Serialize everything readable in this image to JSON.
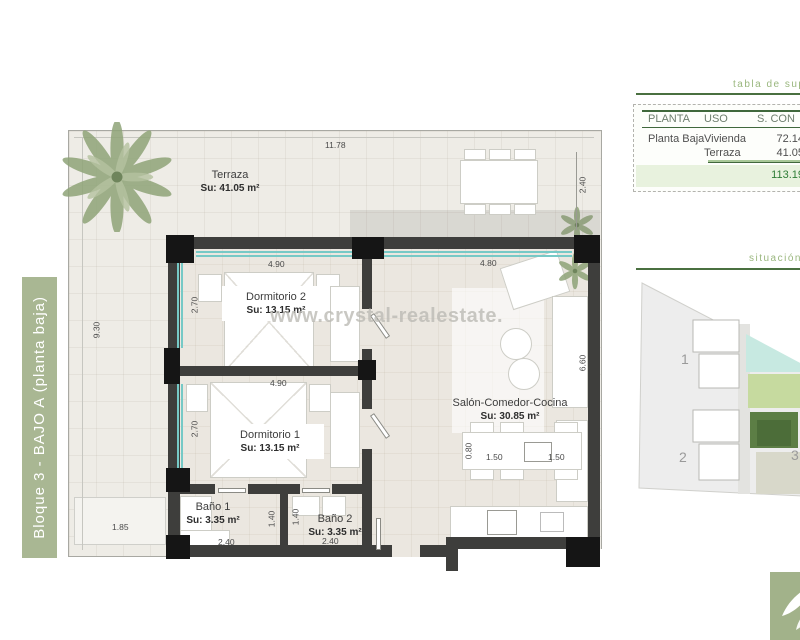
{
  "banner": {
    "text": "Bloque 3 - BAJO A (planta baja)"
  },
  "watermark": "www.crystal-realestate.",
  "plan": {
    "rooms": {
      "terraza": {
        "name": "Terraza",
        "area": "Su: 41.05 m²"
      },
      "dormitorio2": {
        "name": "Dormitorio 2",
        "area": "Su: 13.15 m²"
      },
      "dormitorio1": {
        "name": "Dormitorio 1",
        "area": "Su: 13.15 m²"
      },
      "salon": {
        "name": "Salón-Comedor-Cocina",
        "area": "Su: 30.85 m²"
      },
      "bano1": {
        "name": "Baño 1",
        "area": "Su: 3.35 m²"
      },
      "bano2": {
        "name": "Baño 2",
        "area": "Su: 3.35 m²"
      }
    },
    "dims": {
      "terrace_top": "11.78",
      "terrace_right": "2.40",
      "terrace_left": "9.30",
      "terrace_bottom": "1.85",
      "dorm2_width": "4.90",
      "dorm2_depth": "2.70",
      "dorm1_width": "4.90",
      "dorm1_depth": "2.70",
      "salon_top": "4.80",
      "salon_right": "6.60",
      "dining_depth": "0.80",
      "dining_w1": "1.50",
      "dining_w2": "1.50",
      "bano1_depth": "1.40",
      "bano2_depth": "1.40",
      "bano1_width": "2.40",
      "bano2_width": "2.40"
    }
  },
  "panel": {
    "surfaces_title": "tabla de sup",
    "table": {
      "col_planta": "PLANTA",
      "col_uso": "USO",
      "col_superficie": "S. CON",
      "row1": {
        "planta": "Planta Baja",
        "uso": "Vivienda",
        "sup": "72.14"
      },
      "row2": {
        "uso": "Terraza",
        "sup": "41.05"
      },
      "total": "113.19"
    },
    "location_title": "situación p",
    "site": {
      "block1": "1",
      "block2": "2",
      "block3": "3"
    }
  },
  "colors": {
    "brand_green": "#a9b793",
    "rule_green": "#4a7040",
    "glass_teal": "#76c9c6",
    "wall_dark": "#3e3e3c"
  }
}
